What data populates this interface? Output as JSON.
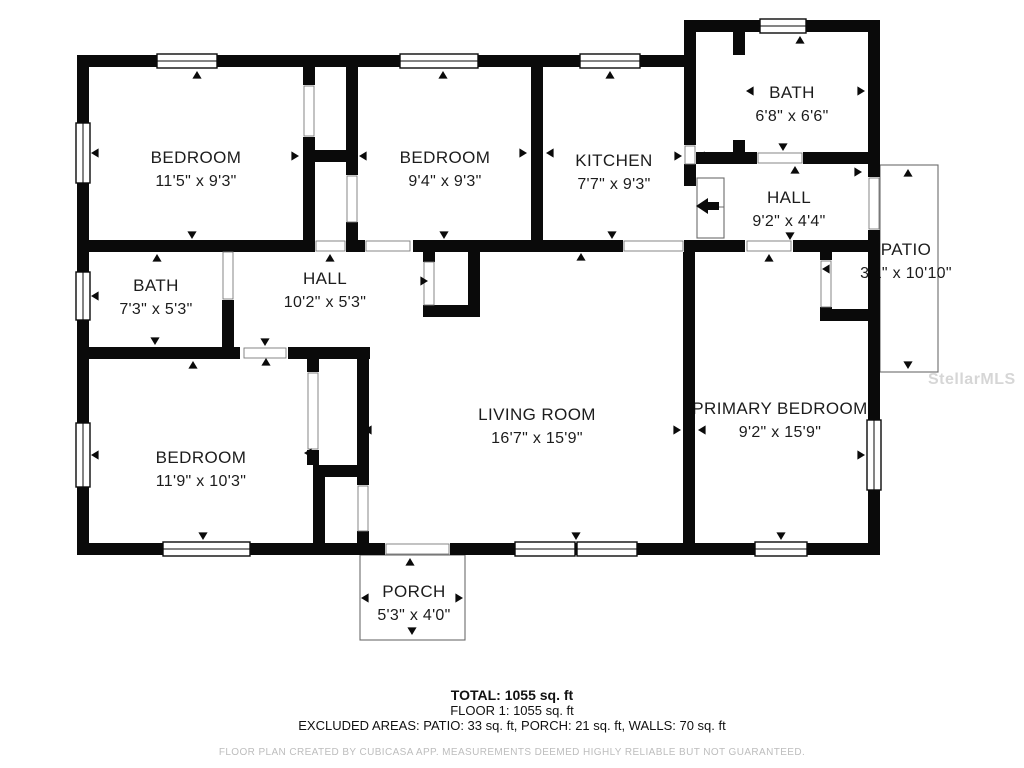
{
  "floorplan": {
    "rooms": [
      {
        "name": "BEDROOM",
        "dims": "11'5\" x 9'3\"",
        "cx": 196,
        "cy": 163
      },
      {
        "name": "BEDROOM",
        "dims": "9'4\" x 9'3\"",
        "cx": 445,
        "cy": 163
      },
      {
        "name": "KITCHEN",
        "dims": "7'7\" x 9'3\"",
        "cx": 614,
        "cy": 166
      },
      {
        "name": "BATH",
        "dims": "6'8\" x 6'6\"",
        "cx": 792,
        "cy": 98
      },
      {
        "name": "HALL",
        "dims": "9'2\" x 4'4\"",
        "cx": 789,
        "cy": 203
      },
      {
        "name": "PATIO",
        "dims": "3'1\" x 10'10\"",
        "cx": 906,
        "cy": 255
      },
      {
        "name": "BATH",
        "dims": "7'3\" x 5'3\"",
        "cx": 156,
        "cy": 291
      },
      {
        "name": "HALL",
        "dims": "10'2\" x 5'3\"",
        "cx": 325,
        "cy": 284
      },
      {
        "name": "LIVING ROOM",
        "dims": "16'7\" x 15'9\"",
        "cx": 537,
        "cy": 420
      },
      {
        "name": "PRIMARY BEDROOM",
        "dims": "9'2\" x 15'9\"",
        "cx": 780,
        "cy": 414
      },
      {
        "name": "BEDROOM",
        "dims": "11'9\" x 10'3\"",
        "cx": 201,
        "cy": 463
      },
      {
        "name": "PORCH",
        "dims": "5'3\" x 4'0\"",
        "cx": 414,
        "cy": 597
      }
    ],
    "summary": {
      "total": "TOTAL: 1055 sq. ft",
      "floor": "FLOOR 1: 1055 sq. ft",
      "excluded": "EXCLUDED AREAS: PATIO: 33 sq. ft, PORCH: 21 sq. ft, WALLS: 70 sq. ft"
    },
    "disclaimer": "FLOOR PLAN CREATED BY CUBICASA APP. MEASUREMENTS DEEMED HIGHLY RELIABLE BUT NOT GUARANTEED.",
    "watermark": "StellarMLS",
    "colors": {
      "wall": "#0a0a0a",
      "text": "#1c1c1c",
      "muted": "#bdbdbd",
      "outline": "#6b6b6b"
    }
  }
}
